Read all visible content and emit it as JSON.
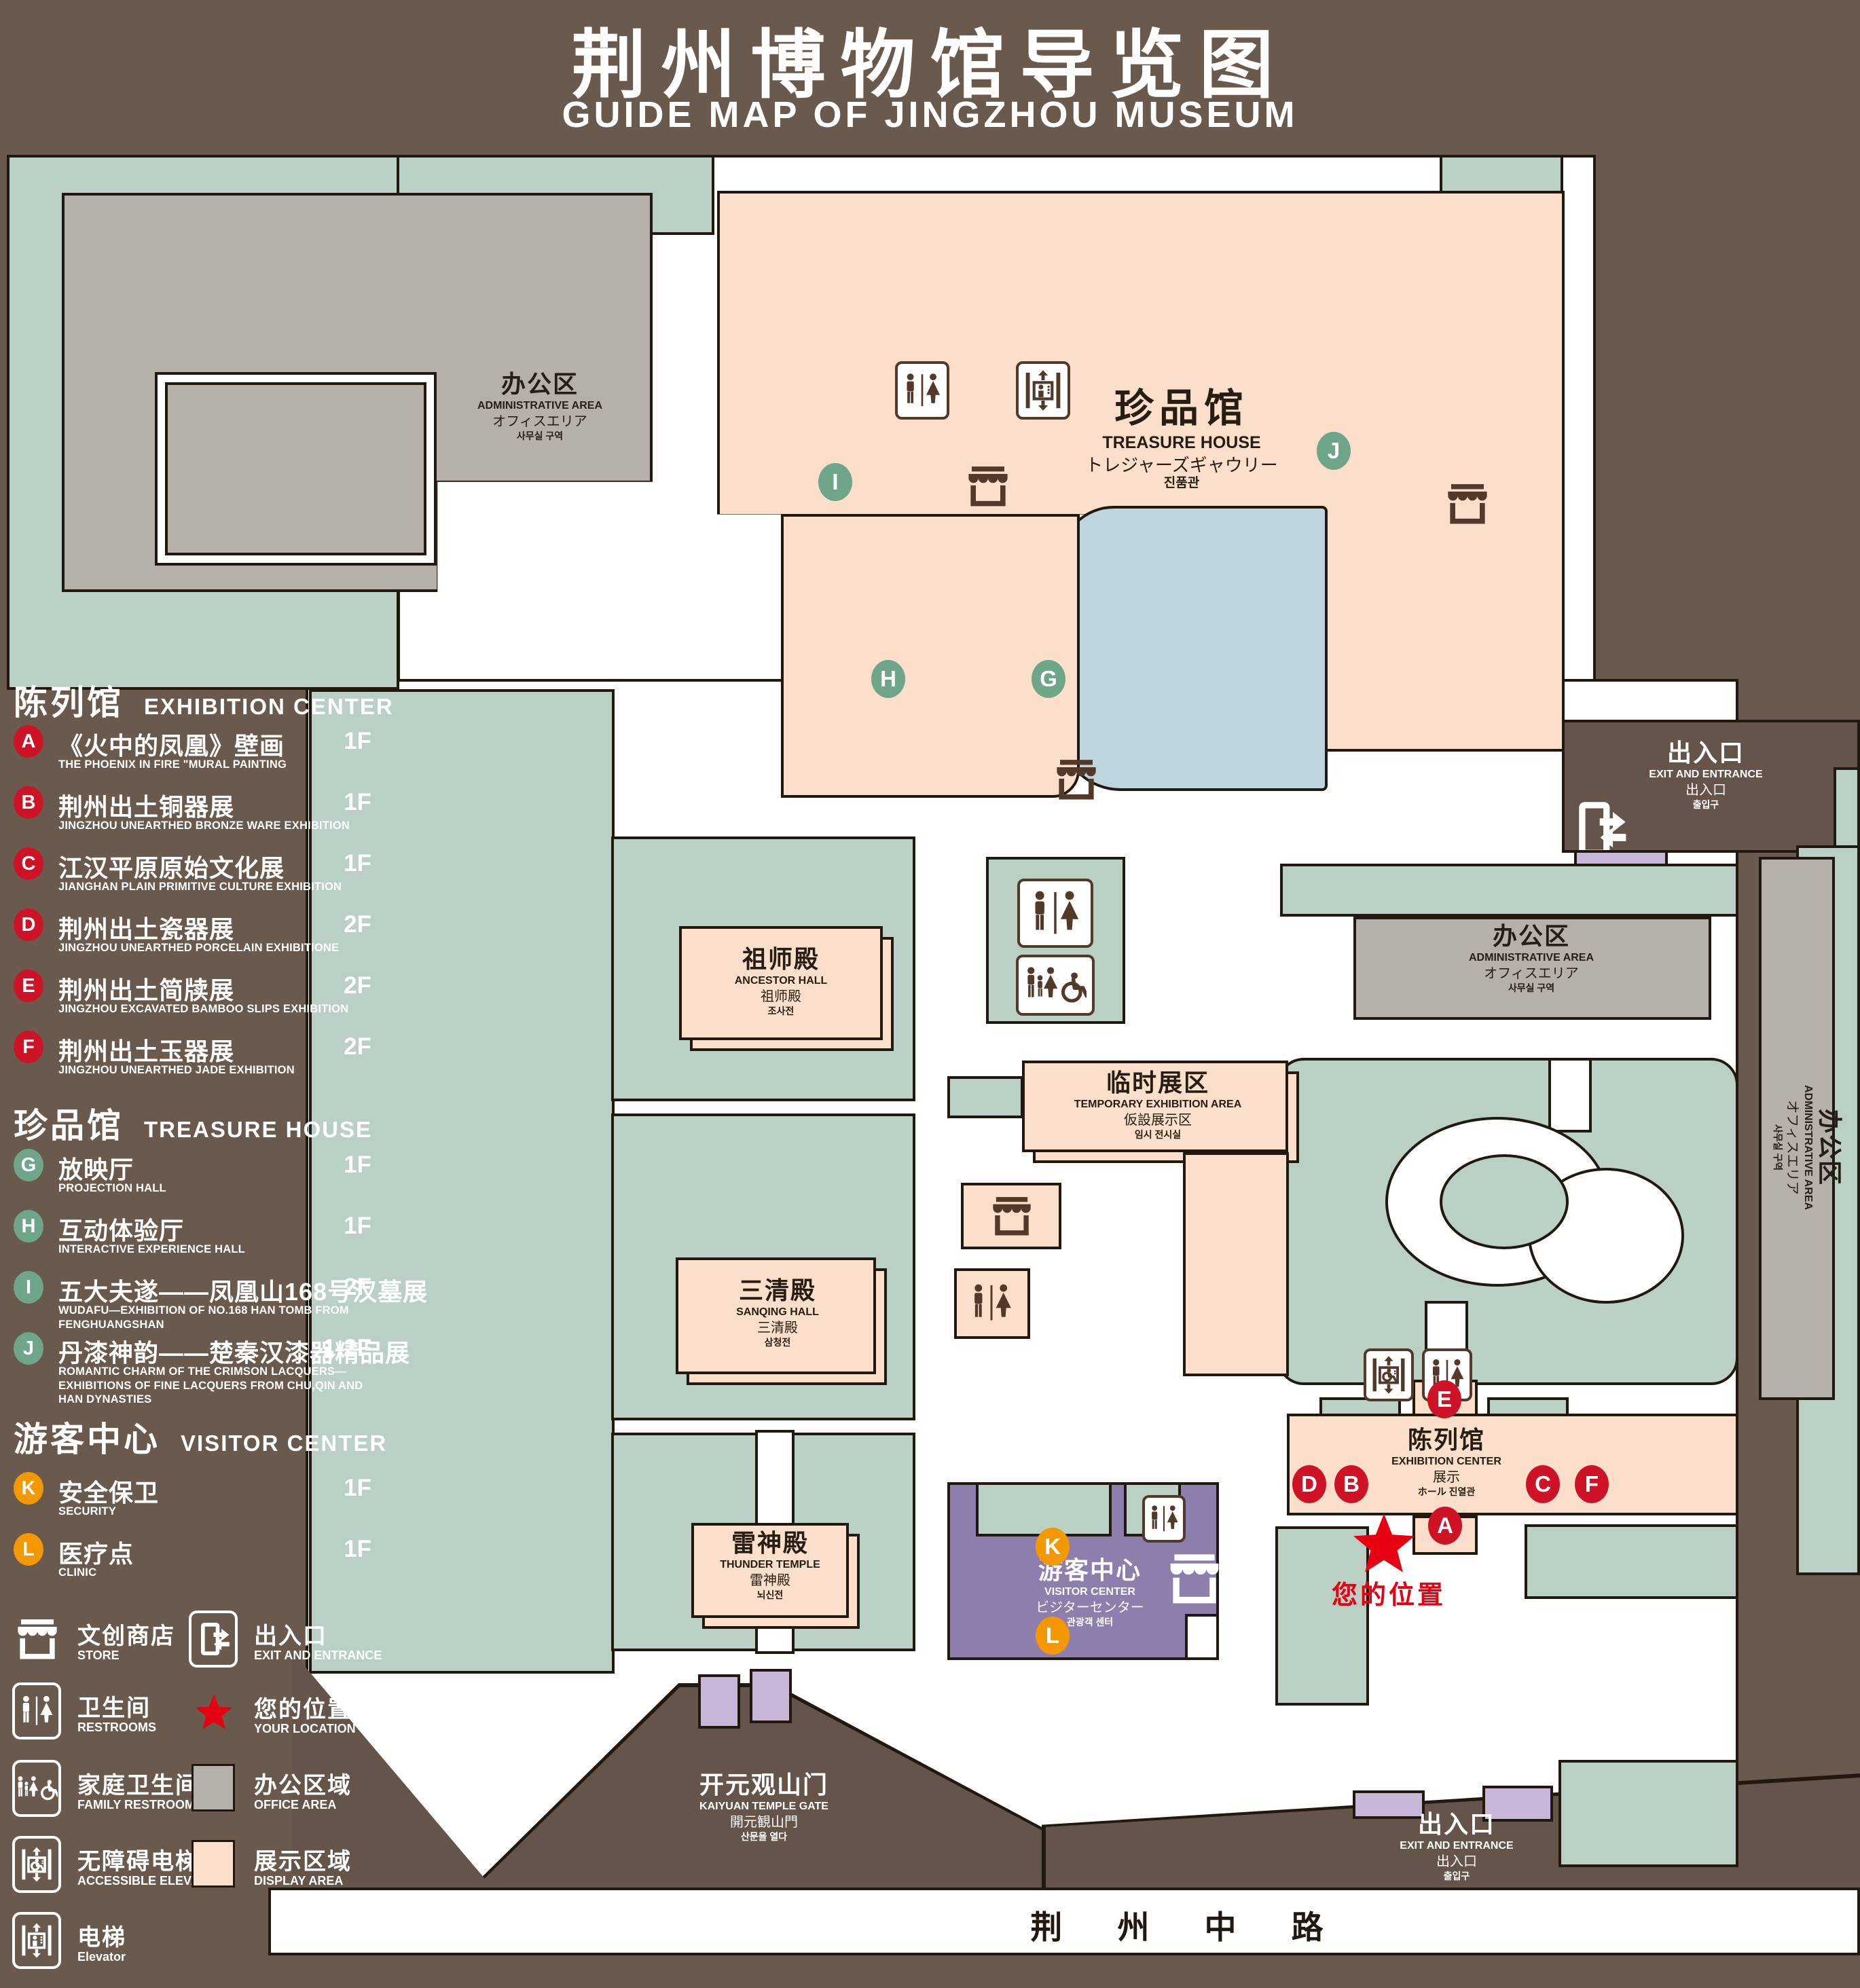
{
  "title": {
    "cn": "荆州博物馆导览图",
    "en": "GUIDE MAP OF JINGZHOU MUSEUM"
  },
  "palette": {
    "background": "#6a594d",
    "green_zone": "#bad0c4",
    "display_pink": "#fbdfca",
    "office_gray": "#b6b0ab",
    "visitor_purple": "#8d7ead",
    "gate_lavender": "#c9b7d9",
    "pond_blue": "#bcd5de",
    "badge_red": "#ce1326",
    "badge_green": "#6fa68a",
    "badge_orange": "#f39800",
    "star_red": "#e60012",
    "outline": "#211910",
    "white": "#ffffff"
  },
  "legend": {
    "sections": [
      {
        "cn": "陈列馆",
        "en": "EXHIBITION CENTER",
        "color": "#ce1326",
        "items": [
          {
            "id": "A",
            "cn": "《火中的凤凰》壁画",
            "en": "THE PHOENIX IN FIRE \"MURAL PAINTING",
            "floor": "1F"
          },
          {
            "id": "B",
            "cn": "荆州出土铜器展",
            "en": "JINGZHOU UNEARTHED BRONZE WARE EXHIBITION",
            "floor": "1F"
          },
          {
            "id": "C",
            "cn": "江汉平原原始文化展",
            "en": "JIANGHAN PLAIN PRIMITIVE CULTURE EXHIBITION",
            "floor": "1F"
          },
          {
            "id": "D",
            "cn": "荆州出土瓷器展",
            "en": "JINGZHOU UNEARTHED PORCELAIN EXHIBITIONE",
            "floor": "2F"
          },
          {
            "id": "E",
            "cn": "荆州出土简牍展",
            "en": "JINGZHOU EXCAVATED BAMBOO SLIPS EXHIBITION",
            "floor": "2F"
          },
          {
            "id": "F",
            "cn": "荆州出土玉器展",
            "en": "JINGZHOU UNEARTHED JADE EXHIBITION",
            "floor": "2F"
          }
        ]
      },
      {
        "cn": "珍品馆",
        "en": "TREASURE HOUSE",
        "color": "#6fa68a",
        "items": [
          {
            "id": "G",
            "cn": "放映厅",
            "en": "PROJECTION HALL",
            "floor": "1F"
          },
          {
            "id": "H",
            "cn": "互动体验厅",
            "en": "INTERACTIVE EXPERIENCE HALL",
            "floor": "1F"
          },
          {
            "id": "I",
            "cn": "五大夫遂——凤凰山168号汉墓展",
            "en": "WUDAFU—EXHIBITION OF NO.168 HAN TOMB FROM FENGHUANGSHAN",
            "floor": "2F"
          },
          {
            "id": "J",
            "cn": "丹漆神韵——楚秦汉漆器精品展",
            "en": "ROMANTIC CHARM OF THE CRIMSON LACQUERS—EXHIBITIONS OF FINE LACQUERS FROM CHU,QIN AND HAN DYNASTIES",
            "floor": "1-2F"
          }
        ]
      },
      {
        "cn": "游客中心",
        "en": "VISITOR CENTER",
        "color": "#f39800",
        "items": [
          {
            "id": "K",
            "cn": "安全保卫",
            "en": "SECURITY",
            "floor": "1F"
          },
          {
            "id": "L",
            "cn": "医疗点",
            "en": "CLINIC",
            "floor": "1F"
          }
        ]
      }
    ],
    "symbols": [
      {
        "icon": "store-icon",
        "cn": "文创商店",
        "en": "STORE"
      },
      {
        "icon": "restrooms-icon",
        "cn": "卫生间",
        "en": "RESTROOMS"
      },
      {
        "icon": "family-restrooms-icon",
        "cn": "家庭卫生间",
        "en": "FAMILY RESTROOMS"
      },
      {
        "icon": "accessible-elevator-icon",
        "cn": "无障碍电梯",
        "en": "ACCESSIBLE ELEVATOR"
      },
      {
        "icon": "elevator-icon",
        "cn": "电梯",
        "en": "Elevator"
      },
      {
        "icon": "exit-icon",
        "cn": "出入口",
        "en": "EXIT AND ENTRANCE"
      },
      {
        "icon": "location-icon",
        "cn": "您的位置",
        "en": "YOUR LOCATION"
      },
      {
        "icon": "office-swatch",
        "cn": "办公区域",
        "en": "OFFICE AREA"
      },
      {
        "icon": "display-swatch",
        "cn": "展示区域",
        "en": "DISPLAY AREA"
      }
    ]
  },
  "map": {
    "admin_area": {
      "cn": "办公区",
      "en": "ADMINISTRATIVE AREA",
      "jp": "オフィスエリア",
      "kr": "사무실 구역"
    },
    "treasure_house": {
      "cn": "珍品馆",
      "en": "TREASURE HOUSE",
      "jp": "トレジャーズギャウリー",
      "kr": "진품관"
    },
    "ancestor_hall": {
      "cn": "祖师殿",
      "en": "ANCESTOR HALL",
      "jp": "祖师殿",
      "kr": "조사전"
    },
    "temporary_exhibition": {
      "cn": "临时展区",
      "en": "TEMPORARY EXHIBITION AREA",
      "jp": "仮設展示区",
      "kr": "임시 전시실"
    },
    "sanqing_hall": {
      "cn": "三清殿",
      "en": "SANQING HALL",
      "jp": "三清殿",
      "kr": "삼청전"
    },
    "thunder_temple": {
      "cn": "雷神殿",
      "en": "THUNDER TEMPLE",
      "jp": "雷神殿",
      "kr": "뇌신전"
    },
    "visitor_center": {
      "cn": "游客中心",
      "en": "VISITOR CENTER",
      "jp": "ビジターセンター",
      "kr": "관광객 센터"
    },
    "exhibition_center": {
      "cn": "陈列馆",
      "en": "EXHIBITION CENTER",
      "jp": "展示",
      "kr": "ホール 진열관"
    },
    "kaiyuan_gate": {
      "cn": "开元观山门",
      "en": "KAIYUAN TEMPLE GATE",
      "jp": "開元観山門",
      "kr": "산문을 열다"
    },
    "exit_gate": {
      "cn": "出入口",
      "en": "EXIT AND ENTRANCE",
      "jp": "出入口",
      "kr": "출입구"
    },
    "road": {
      "name": "荆 州 中 路"
    },
    "your_location": {
      "cn": "您的位置"
    }
  }
}
